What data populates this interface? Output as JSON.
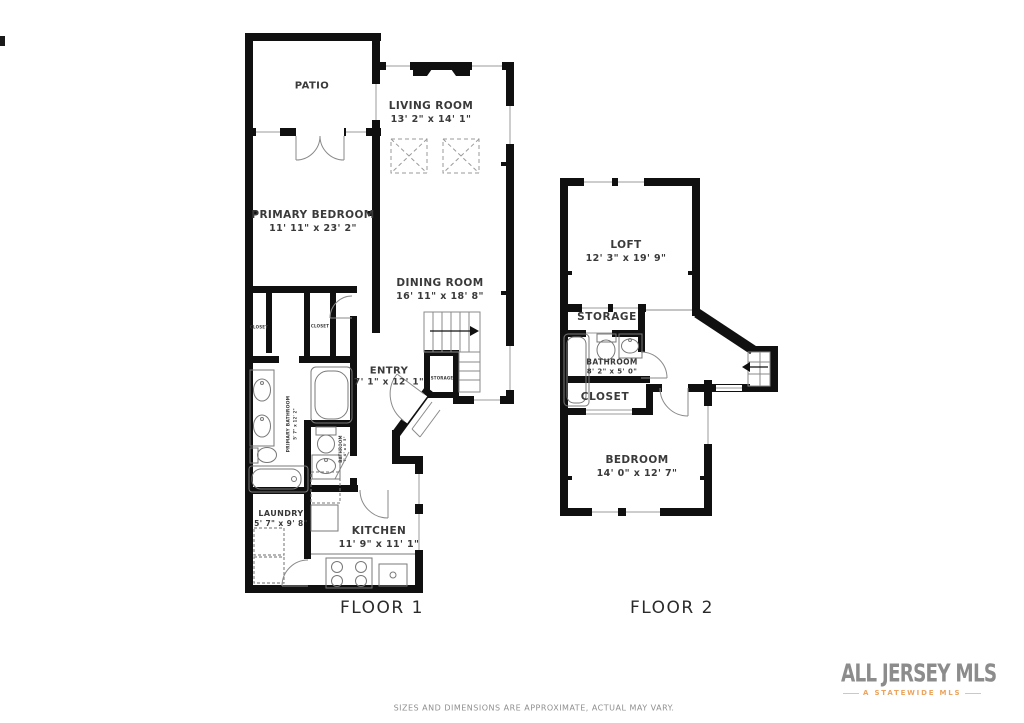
{
  "colors": {
    "wall": "#101010",
    "thin_line": "#8a8a8a",
    "text": "#3a3a3a",
    "logo_orange": "#eda45e",
    "logo_teal": "#86a7a0",
    "logo_gray": "#8c8c8c"
  },
  "floor1": {
    "title": "FLOOR 1",
    "rooms": {
      "patio": {
        "name": "PATIO"
      },
      "living_room": {
        "name": "LIVING ROOM",
        "dims": "13' 2\" x 14' 1\""
      },
      "primary_bedroom": {
        "name": "PRIMARY BEDROOM",
        "dims": "11' 11\" x 23' 2\""
      },
      "dining_room": {
        "name": "DINING ROOM",
        "dims": "16' 11\" x 18' 8\""
      },
      "entry": {
        "name": "ENTRY",
        "dims": "7' 1\" x 12' 1\""
      },
      "storage": {
        "name": "STORAGE"
      },
      "closet_left": {
        "name": "CLOSET"
      },
      "closet_right": {
        "name": "CLOSET"
      },
      "primary_bathroom": {
        "name": "PRIMARY BATHROOM",
        "dims": "5' 7\" x 12' 2\""
      },
      "bathroom": {
        "name": "BATHROOM",
        "dims": "7' 4\" x 5' 5\""
      },
      "laundry": {
        "name": "LAUNDRY",
        "dims": "5' 7\" x 9' 8\""
      },
      "kitchen": {
        "name": "KITCHEN",
        "dims": "11' 9\" x 11' 1\""
      }
    }
  },
  "floor2": {
    "title": "FLOOR 2",
    "rooms": {
      "loft": {
        "name": "LOFT",
        "dims": "12' 3\" x 19' 9\""
      },
      "storage": {
        "name": "STORAGE"
      },
      "bathroom": {
        "name": "BATHROOM",
        "dims": "8' 2\" x 5' 0\""
      },
      "closet": {
        "name": "CLOSET"
      },
      "bedroom": {
        "name": "BEDROOM",
        "dims": "14' 0\" x 12' 7\""
      }
    }
  },
  "branding": {
    "name": "ALL JERSEY MLS",
    "tagline": "A STATEWIDE MLS"
  },
  "footer": {
    "disclaimer": "SIZES AND DIMENSIONS ARE APPROXIMATE, ACTUAL MAY VARY."
  }
}
